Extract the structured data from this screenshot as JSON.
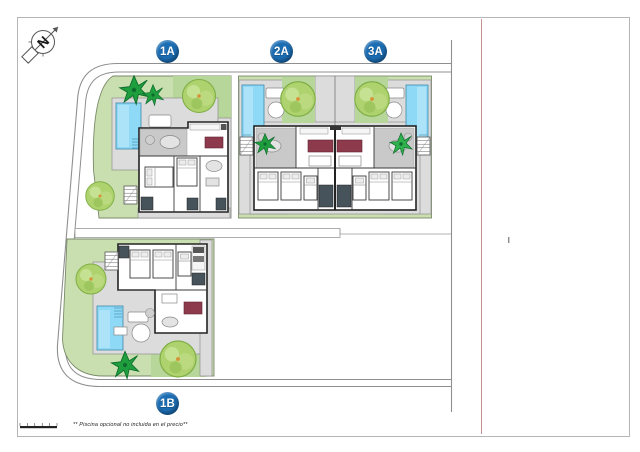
{
  "badges": [
    {
      "label": "1A"
    },
    {
      "label": "2A"
    },
    {
      "label": "3A"
    },
    {
      "label": "1B"
    }
  ],
  "footnote": "** Piscina opcional no incluida en el precio**",
  "icons": {
    "compass": "north-arrow-icon",
    "scale": "scale-bar"
  },
  "colors": {
    "badge_blue": "#1b6db3",
    "plot_green": "#cadfb0",
    "patch_green": "#b7d69a",
    "terrace_gray": "#dcdcdc",
    "pool_blue": "#8ed9f5",
    "sofa_maroon": "#8e3a4d",
    "tree_light": "#aed26e",
    "tree_dark": "#1f9e3e",
    "tree_vivid": "#2fb14d",
    "road_gray": "#8f8f8f",
    "boundary_pink": "#c49090",
    "wall_dark": "#232323"
  }
}
